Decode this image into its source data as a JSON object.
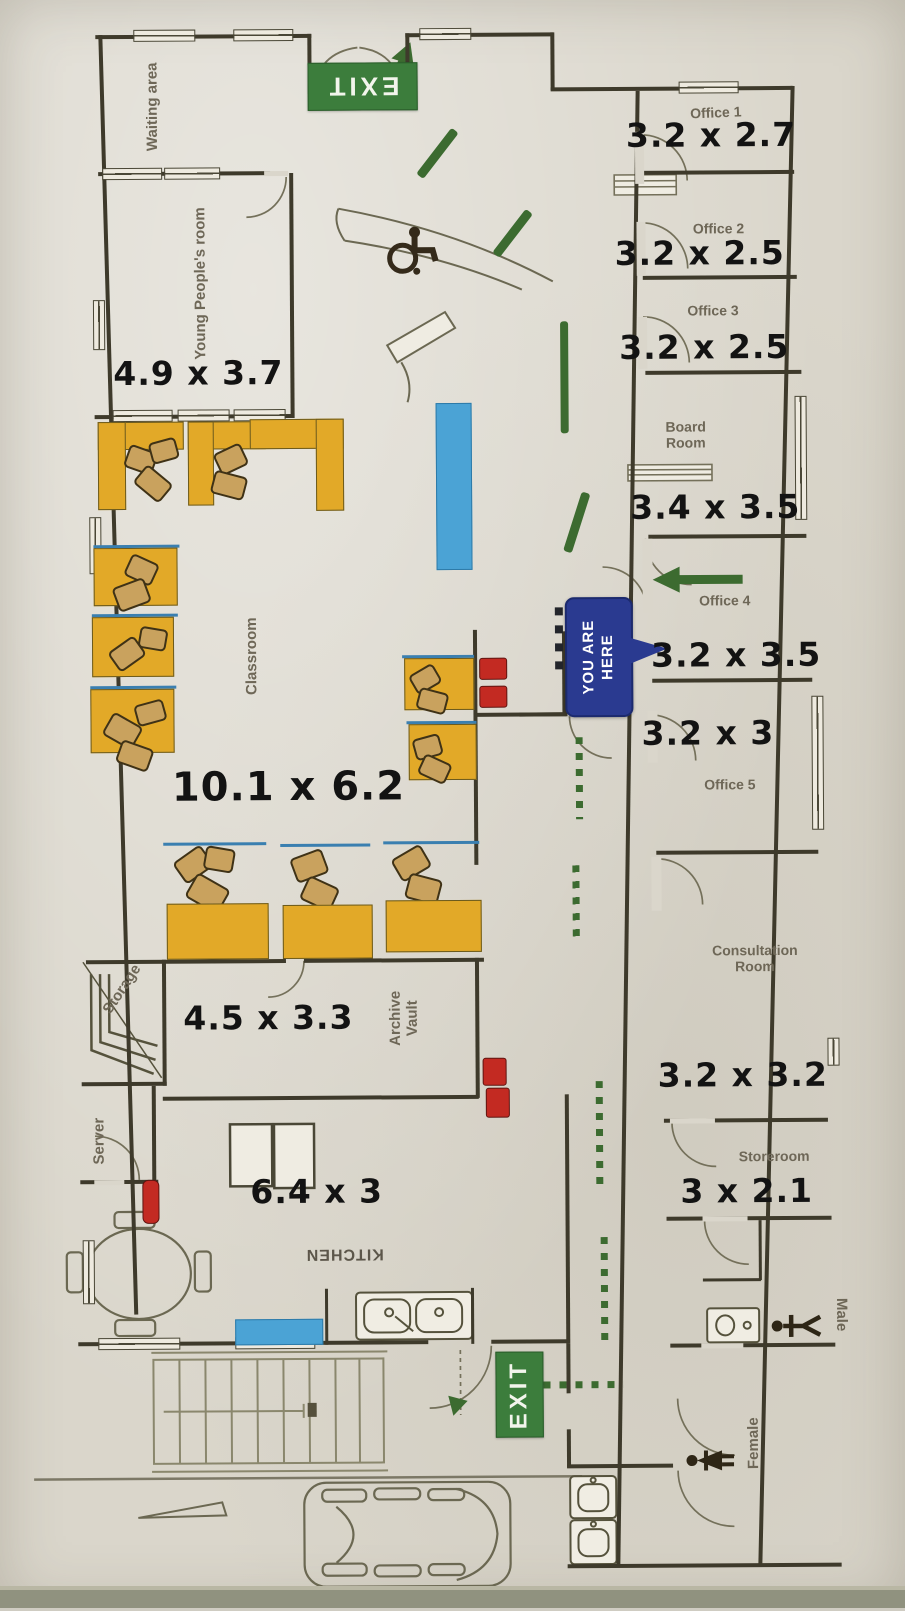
{
  "plan": {
    "rooms": {
      "waiting": {
        "name": "Waiting area"
      },
      "young": {
        "name": "Young People's room",
        "dim": "4.9 x 3.7"
      },
      "classroom": {
        "name": "Classroom",
        "dim": "10.1 x 6.2"
      },
      "office1": {
        "name": "Office 1",
        "dim": "3.2 x 2.7"
      },
      "office2": {
        "name": "Office 2",
        "dim": "3.2 x 2.5"
      },
      "office3": {
        "name": "Office 3",
        "dim": "3.2 x 2.5"
      },
      "boardroom": {
        "name": "Board Room",
        "dim": "3.4 x 3.5"
      },
      "office4": {
        "name": "Office 4",
        "dim": "3.2 x 3.5"
      },
      "office5": {
        "name": "Office 5",
        "dim": "3.2 x 3"
      },
      "consultation": {
        "name": "Consultation Room",
        "dim": "3.2 x 3.2"
      },
      "storeroom": {
        "name": "Storeroom",
        "dim": "3 x 2.1"
      },
      "storage": {
        "name": "Storage"
      },
      "archive": {
        "name": "Archive Vault",
        "dim": "4.5 x 3.3"
      },
      "server": {
        "name": "Server"
      },
      "kitchen": {
        "name": "KITCHEN",
        "dim": "6.4 x 3"
      },
      "male": {
        "name": "Male"
      },
      "female": {
        "name": "Female"
      }
    },
    "signs": {
      "exit": "EXIT",
      "you_are_here_line1": "YOU ARE",
      "you_are_here_line2": "HERE"
    },
    "colors": {
      "exit_green": "#3c7d3c",
      "route_green": "#3c6b30",
      "marker_blue": "#2a3a90",
      "desk_yellow": "#e2a928",
      "board_blue": "#4ba3d5",
      "alert_red": "#c32a22"
    }
  }
}
